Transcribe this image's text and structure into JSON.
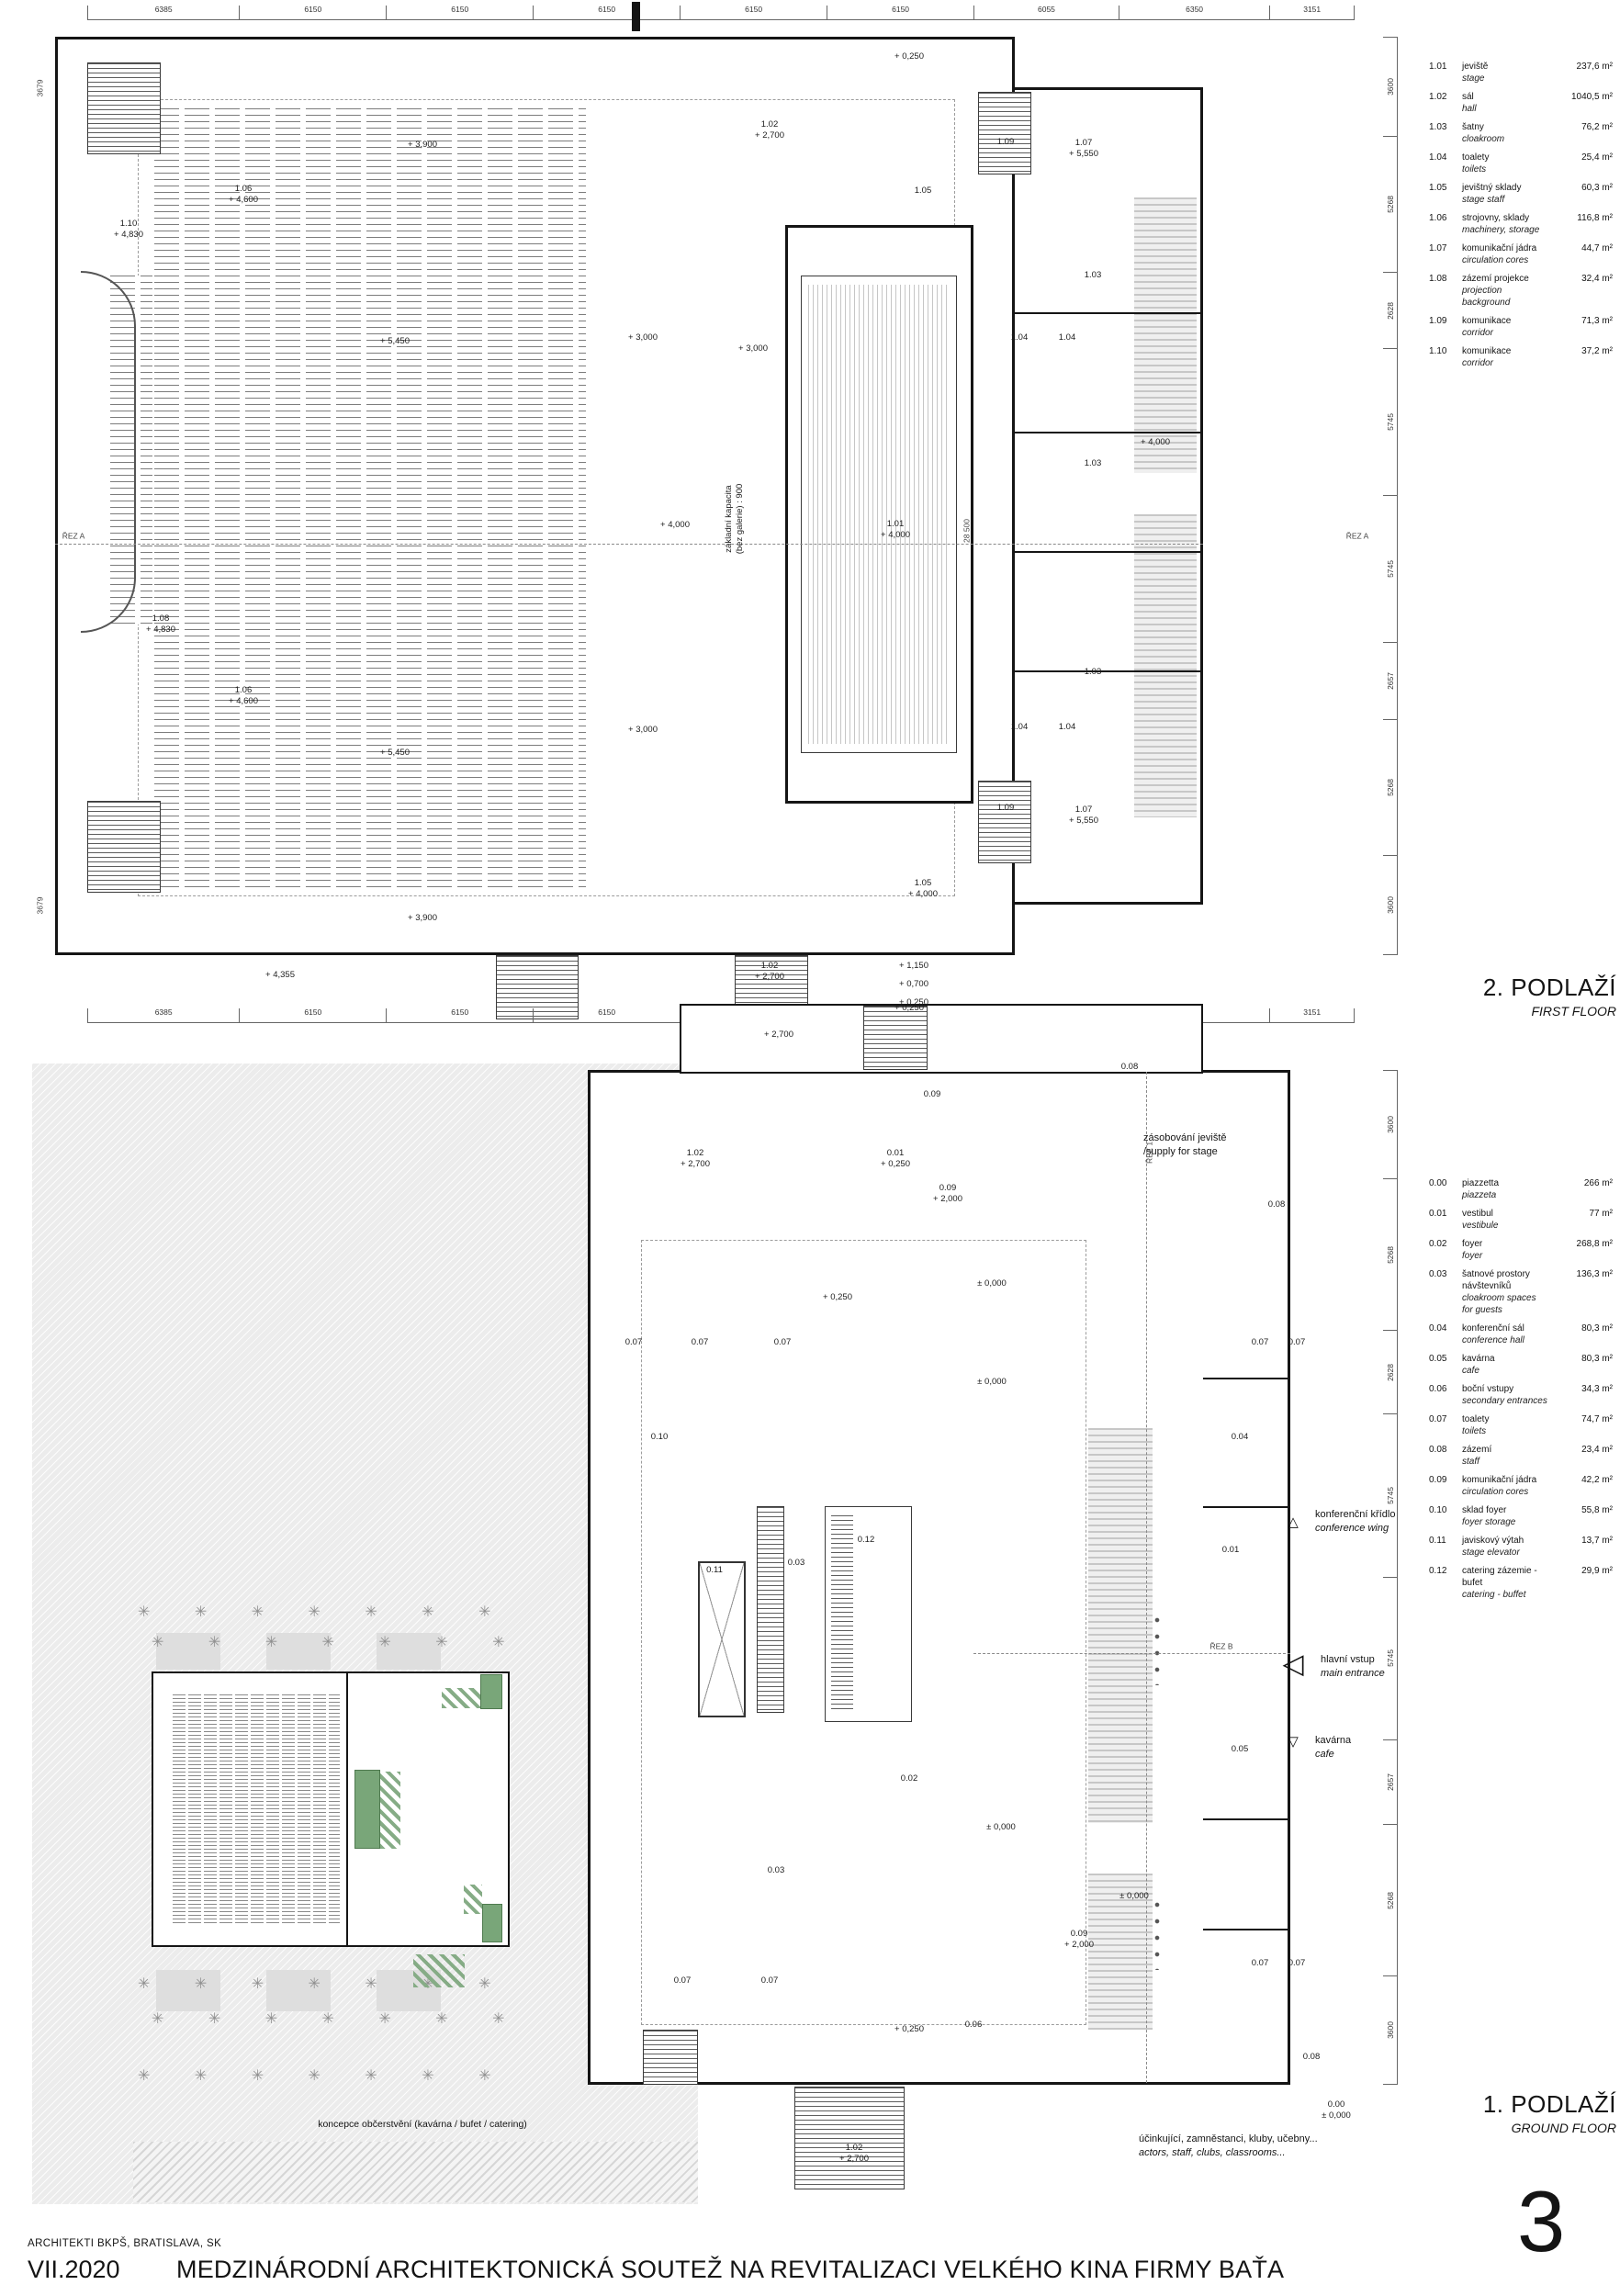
{
  "board": {
    "page_number": "3",
    "architects": "ARCHITEKTI BKPŠ, BRATISLAVA, SK",
    "date": "VII.2020",
    "title": "MEDZINÁRODNÍ ARCHITEKTONICKÁ SOUTEŽ NA REVITALIZACI VELKÉHO KINA FIRMY BAŤA"
  },
  "colors": {
    "accent_green": "#79a679",
    "hatch_gray": "#d9d9d9",
    "site_gray": "#ececec",
    "line": "#151515"
  },
  "icons": {
    "triangle_up": "△",
    "triangle_left": "◁",
    "triangle_down": "▽",
    "tree": "✳"
  },
  "first_floor": {
    "title_cz": "2. PODLAŽÍ",
    "title_en": "FIRST FLOOR",
    "dims_top": [
      "6385",
      "6150",
      "6150",
      "6150",
      "6150",
      "6150",
      "6055",
      "6350",
      "3151"
    ],
    "dims_right": [
      "3600",
      "5268",
      "2628",
      "5745",
      "5745",
      "2657",
      "5268",
      "3600"
    ],
    "legend": [
      {
        "id": "1.01",
        "cz": "jeviště",
        "en": "stage",
        "area": "237,6 m²"
      },
      {
        "id": "1.02",
        "cz": "sál",
        "en": "hall",
        "area": "1040,5 m²"
      },
      {
        "id": "1.03",
        "cz": "šatny",
        "en": "cloakroom",
        "area": "76,2 m²"
      },
      {
        "id": "1.04",
        "cz": "toalety",
        "en": "toilets",
        "area": "25,4 m²"
      },
      {
        "id": "1.05",
        "cz": "jevištný sklady",
        "en": "stage staff",
        "area": "60,3 m²"
      },
      {
        "id": "1.06",
        "cz": "strojovny, sklady",
        "en": "machinery, storage",
        "area": "116,8 m²"
      },
      {
        "id": "1.07",
        "cz": "komunikační jádra",
        "en": "circulation cores",
        "area": "44,7 m²"
      },
      {
        "id": "1.08",
        "cz": "zázemí projekce",
        "en": "projection background",
        "area": "32,4 m²"
      },
      {
        "id": "1.09",
        "cz": "komunikace",
        "en": "corridor",
        "area": "71,3 m²"
      },
      {
        "id": "1.10",
        "cz": "komunikace",
        "en": "corridor",
        "area": "37,2 m²"
      }
    ],
    "tags": [
      [
        990,
        62,
        "+ 0,250"
      ],
      [
        838,
        142,
        "1.02\n+ 2,700"
      ],
      [
        460,
        158,
        "+ 3,900"
      ],
      [
        1005,
        208,
        "1.05"
      ],
      [
        265,
        212,
        "1.06\n+ 4,600"
      ],
      [
        140,
        250,
        "1.10\n+ 4,830"
      ],
      [
        1190,
        300,
        "1.03"
      ],
      [
        1110,
        368,
        "1.04"
      ],
      [
        1162,
        368,
        "1.04"
      ],
      [
        430,
        372,
        "+ 5,450"
      ],
      [
        700,
        368,
        "+ 3,000"
      ],
      [
        820,
        380,
        "+ 3,000"
      ],
      [
        975,
        577,
        "1.01\n+ 4,000"
      ],
      [
        735,
        572,
        "+ 4,000"
      ],
      [
        1053,
        578,
        "28 500",
        "rot small"
      ],
      [
        800,
        565,
        "základní kapacita\n(bez galerie) : 900",
        "rot"
      ],
      [
        1258,
        482,
        "+ 4,000"
      ],
      [
        1190,
        505,
        "1.03"
      ],
      [
        175,
        680,
        "1.08\n+ 4,830"
      ],
      [
        265,
        758,
        "1.06\n+ 4,600"
      ],
      [
        700,
        795,
        "+ 3,000"
      ],
      [
        430,
        820,
        "+ 5,450"
      ],
      [
        1110,
        792,
        "1.04"
      ],
      [
        1162,
        792,
        "1.04"
      ],
      [
        1190,
        732,
        "1.03"
      ],
      [
        1095,
        155,
        "1.09"
      ],
      [
        1095,
        880,
        "1.09"
      ],
      [
        1180,
        162,
        "1.07\n+ 5,550"
      ],
      [
        1180,
        888,
        "1.07\n+ 5,550"
      ],
      [
        1005,
        968,
        "1.05\n+ 4,000"
      ],
      [
        460,
        1000,
        "+ 3,900"
      ],
      [
        305,
        1062,
        "+ 4,355"
      ],
      [
        838,
        1058,
        "1.02\n+ 2,700"
      ],
      [
        990,
        1098,
        "+ 0,250"
      ],
      [
        848,
        1127,
        "+ 2,700"
      ],
      [
        44,
        96,
        "3679",
        "rot small"
      ],
      [
        44,
        986,
        "3679",
        "rot small"
      ],
      [
        80,
        584,
        "ŘEZ A",
        "small"
      ],
      [
        1478,
        584,
        "ŘEZ A",
        "small"
      ]
    ]
  },
  "ground_floor": {
    "title_cz": "1. PODLAŽÍ",
    "title_en": "GROUND FLOOR",
    "dims_top": [
      "6385",
      "6150",
      "6150",
      "6150",
      "6150",
      "6150",
      "6055",
      "6350",
      "3151"
    ],
    "dims_right": [
      "3600",
      "5268",
      "2628",
      "5745",
      "5745",
      "2657",
      "5268",
      "3600"
    ],
    "legend": [
      {
        "id": "0.00",
        "cz": "piazzetta",
        "en": "piazzeta",
        "area": "266 m²"
      },
      {
        "id": "0.01",
        "cz": "vestibul",
        "en": "vestibule",
        "area": "77 m²"
      },
      {
        "id": "0.02",
        "cz": "foyer",
        "en": "foyer",
        "area": "268,8 m²"
      },
      {
        "id": "0.03",
        "cz": "šatnové prostory návštevníků",
        "en": "cloakroom spaces for guests",
        "area": "136,3 m²"
      },
      {
        "id": "0.04",
        "cz": "konferenční sál",
        "en": "conference hall",
        "area": "80,3 m²"
      },
      {
        "id": "0.05",
        "cz": "kavárna",
        "en": "cafe",
        "area": "80,3 m²"
      },
      {
        "id": "0.06",
        "cz": "boční vstupy",
        "en": "secondary entrances",
        "area": "34,3 m²"
      },
      {
        "id": "0.07",
        "cz": "toalety",
        "en": "toilets",
        "area": "74,7 m²"
      },
      {
        "id": "0.08",
        "cz": "zázemí",
        "en": "staff",
        "area": "23,4 m²"
      },
      {
        "id": "0.09",
        "cz": "komunikační jádra",
        "en": "circulation cores",
        "area": "42,2 m²"
      },
      {
        "id": "0.10",
        "cz": "sklad foyer",
        "en": "foyer storage",
        "area": "55,8 m²"
      },
      {
        "id": "0.11",
        "cz": "javiskový výtah",
        "en": "stage elevator",
        "area": "13,7 m²"
      },
      {
        "id": "0.12",
        "cz": "catering zázemie - bufet",
        "en": "catering - buffet",
        "area": "29,9 m²"
      }
    ],
    "tags": [
      [
        995,
        1052,
        "+ 1,150"
      ],
      [
        995,
        1072,
        "+ 0,700"
      ],
      [
        995,
        1092,
        "+ 0,250"
      ],
      [
        757,
        1262,
        "1.02\n+ 2,700"
      ],
      [
        975,
        1262,
        "0.01\n+ 0,250"
      ],
      [
        1015,
        1192,
        "0.09"
      ],
      [
        1032,
        1300,
        "0.09\n+ 2,000"
      ],
      [
        1080,
        1398,
        "± 0,000"
      ],
      [
        1230,
        1162,
        "0.08"
      ],
      [
        690,
        1462,
        "0.07"
      ],
      [
        762,
        1462,
        "0.07"
      ],
      [
        852,
        1462,
        "0.07"
      ],
      [
        912,
        1413,
        "+ 0,250"
      ],
      [
        718,
        1565,
        "0.10"
      ],
      [
        943,
        1677,
        "0.12"
      ],
      [
        867,
        1702,
        "0.03"
      ],
      [
        778,
        1710,
        "0.11"
      ],
      [
        1080,
        1505,
        "± 0,000"
      ],
      [
        845,
        2037,
        "0.03"
      ],
      [
        990,
        1937,
        "0.02"
      ],
      [
        1090,
        1990,
        "± 0,000"
      ],
      [
        1350,
        1565,
        "0.04"
      ],
      [
        1350,
        1905,
        "0.05"
      ],
      [
        1340,
        1688,
        "0.01"
      ],
      [
        1390,
        1312,
        "0.08"
      ],
      [
        1428,
        2240,
        "0.08"
      ],
      [
        1372,
        1462,
        "0.07"
      ],
      [
        1412,
        1462,
        "0.07"
      ],
      [
        1372,
        2138,
        "0.07"
      ],
      [
        1412,
        2138,
        "0.07"
      ],
      [
        1175,
        2112,
        "0.09\n+ 2,000"
      ],
      [
        1060,
        2205,
        "0.06"
      ],
      [
        990,
        2210,
        "+ 0,250"
      ],
      [
        930,
        2345,
        "1.02\n+ 2,700"
      ],
      [
        1455,
        2298,
        "0.00\n± 0,000"
      ],
      [
        743,
        2157,
        "0.07"
      ],
      [
        838,
        2157,
        "0.07"
      ],
      [
        1235,
        2065,
        "± 0,000"
      ],
      [
        1252,
        1255,
        "ŘEZ 1",
        "rot small"
      ],
      [
        1330,
        1793,
        "ŘEZ B",
        "small"
      ]
    ],
    "annotations": {
      "supply_cz": "zásobování jeviště",
      "supply_en": "/supply for stage",
      "conference_cz": "konferenční křídlo",
      "conference_en": "conference wing",
      "entrance_cz": "hlavní vstup",
      "entrance_en": "main entrance",
      "cafe_cz": "kavárna",
      "cafe_en": "cafe",
      "staff_cz": "účinkující, zamněstanci, kluby, učebny...",
      "staff_en": "actors, staff, clubs, classrooms...",
      "inset_caption": "koncepce občerstvění (kavárna / bufet / catering)"
    },
    "inset": {
      "tree_row": "✳  ✳  ✳  ✳  ✳  ✳  ✳"
    }
  }
}
